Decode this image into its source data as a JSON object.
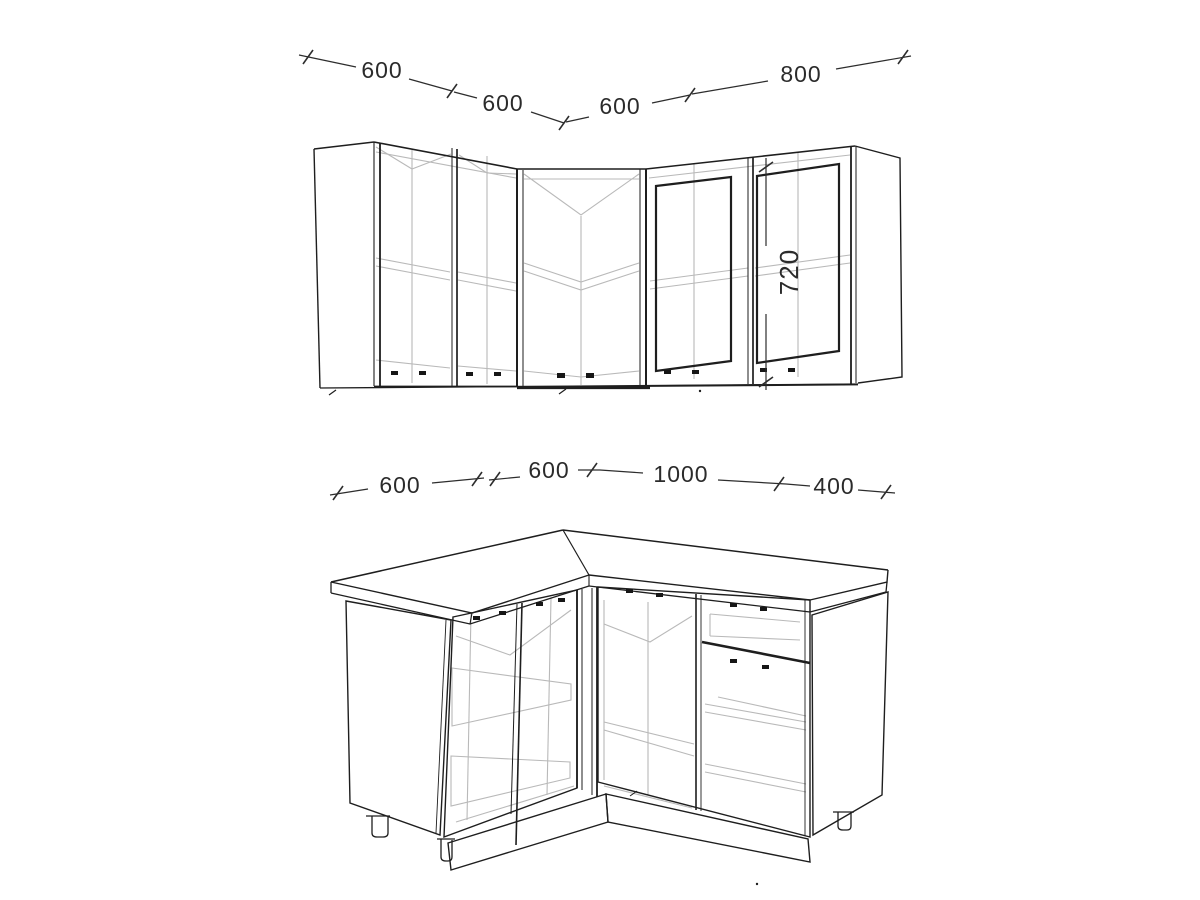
{
  "dims": {
    "upper": [
      "600",
      "600",
      "600",
      "800"
    ],
    "upper_height": "720",
    "base": [
      "600",
      "600",
      "1000",
      "400"
    ]
  },
  "colors": {
    "ink": "#1e1e1e",
    "light_ink": "#b9b9b9",
    "dim_line": "#2d2d2d",
    "dim_text": "#2b2b2b",
    "background": "#ffffff"
  }
}
